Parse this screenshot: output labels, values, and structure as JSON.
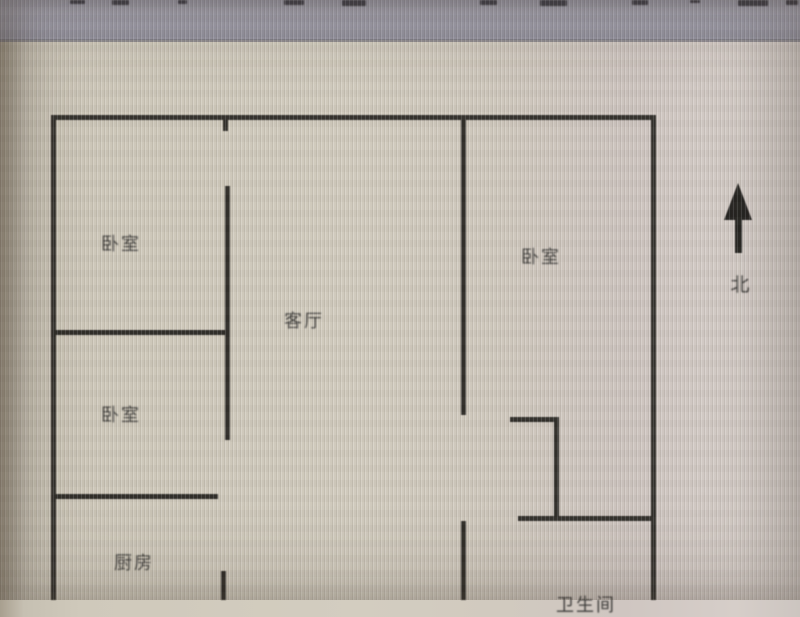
{
  "floorplan": {
    "rooms": [
      {
        "id": "bedroom-top-left",
        "label": "卧室"
      },
      {
        "id": "bedroom-mid-left",
        "label": "卧室"
      },
      {
        "id": "bedroom-right",
        "label": "卧室"
      },
      {
        "id": "living-room",
        "label": "客厅"
      },
      {
        "id": "kitchen",
        "label": "厨房"
      },
      {
        "id": "bathroom",
        "label": "卫生间"
      }
    ],
    "compass": {
      "label": "北",
      "direction": "up"
    },
    "colors": {
      "wall": "#2c2a26",
      "background": "#d2ccbf",
      "toolbar_band": "#9e9dab",
      "label_text": "#3b3a38"
    }
  }
}
